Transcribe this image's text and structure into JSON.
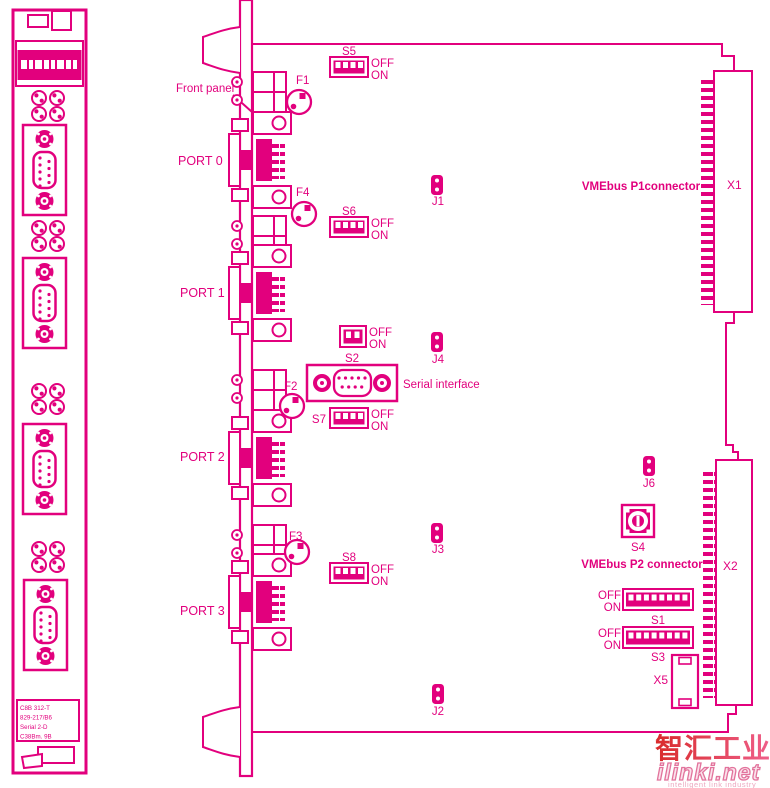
{
  "colors": {
    "line": "#e2007d",
    "watermark_red": "#d92b2b",
    "watermark_pink": "#ef5f8a"
  },
  "front_panel_view": {
    "label_lines": [
      "C8B 312-T",
      "829-217/B6",
      "Serial 2-D",
      "C38Bm. 9B"
    ]
  },
  "diagram": {
    "front_panel_label": "Front panel",
    "ports": [
      {
        "label": "PORT 0"
      },
      {
        "label": "PORT 1"
      },
      {
        "label": "PORT 2"
      },
      {
        "label": "PORT 3"
      }
    ],
    "fuses": [
      {
        "label": "F1"
      },
      {
        "label": "F4"
      },
      {
        "label": "F2"
      },
      {
        "label": "F3"
      }
    ],
    "jumpers": [
      {
        "label": "J1"
      },
      {
        "label": "J4"
      },
      {
        "label": "J3"
      },
      {
        "label": "J2"
      },
      {
        "label": "J6"
      }
    ],
    "switches": {
      "s5": {
        "label": "S5",
        "off": "OFF",
        "on": "ON"
      },
      "s6": {
        "label": "S6",
        "off": "OFF",
        "on": "ON"
      },
      "s2": {
        "label": "S2",
        "off": "OFF",
        "on": "ON"
      },
      "s7": {
        "label": "S7",
        "off": "OFF",
        "on": "ON"
      },
      "s8": {
        "label": "S8",
        "off": "OFF",
        "on": "ON"
      },
      "s1": {
        "label": "S1",
        "off": "OFF",
        "on": "ON"
      },
      "s3": {
        "label": "S3",
        "off": "OFF",
        "on": "ON"
      },
      "s4": {
        "label": "S4"
      }
    },
    "connectors": {
      "x1": {
        "label": "X1",
        "title": "VMEbus P1connector"
      },
      "x2": {
        "label": "X2",
        "title": "VMEbus P2 connector"
      },
      "x5": {
        "label": "X5"
      },
      "serial": {
        "label": "Serial interface"
      }
    }
  },
  "watermark": {
    "cn": "智汇工业",
    "domain": "ilinki.net",
    "tagline": "intelligent link industry"
  }
}
